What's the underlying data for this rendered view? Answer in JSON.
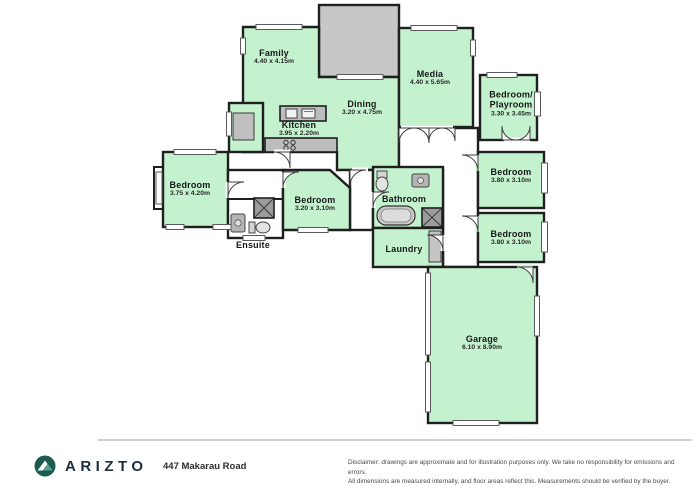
{
  "rooms": {
    "family": {
      "name": "Family",
      "dims": "4.40 x 4.15m"
    },
    "media": {
      "name": "Media",
      "dims": "4.40 x 5.65m"
    },
    "playroom": {
      "name_line1": "Bedroom/",
      "name_line2": "Playroom",
      "dims": "3.30 x 3.45m"
    },
    "dining": {
      "name": "Dining",
      "dims": "3.20 x 4.75m"
    },
    "kitchen": {
      "name": "Kitchen",
      "dims": "3.95 x 2.20m"
    },
    "bedroom_left": {
      "name": "Bedroom",
      "dims": "3.75 x 4.20m"
    },
    "bedroom_mid": {
      "name": "Bedroom",
      "dims": "3.20 x 3.10m"
    },
    "bathroom": {
      "name": "Bathroom"
    },
    "ensuite": {
      "name": "Ensuite"
    },
    "laundry": {
      "name": "Laundry"
    },
    "bedroom_r1": {
      "name": "Bedroom",
      "dims": "3.80 x 3.10m"
    },
    "bedroom_r2": {
      "name": "Bedroom",
      "dims": "3.80 x 3.10m"
    },
    "garage": {
      "name": "Garage",
      "dims": "6.10 x 8.90m"
    }
  },
  "footer": {
    "brand": "ARIZTO",
    "address": "447 Makarau Road",
    "disclaimer_line1": "Disclaimer: drawings are approximate and for illustration purposes only. We take no responsibility for omissions and errors.",
    "disclaimer_line2": "All dimensions are measured internally, and floor areas reflect this. Measurements should be verified by the buyer."
  },
  "colors": {
    "room_fill": "#c4f2cf",
    "wall": "#1f1f1f",
    "gray_area": "#c7c7c7",
    "fixture_gray": "#bdbdbd",
    "brand_navy": "#1b2d3e",
    "logo_teal": "#1d5a50"
  },
  "icons": {
    "logo": "arizto-mountain-logo"
  }
}
